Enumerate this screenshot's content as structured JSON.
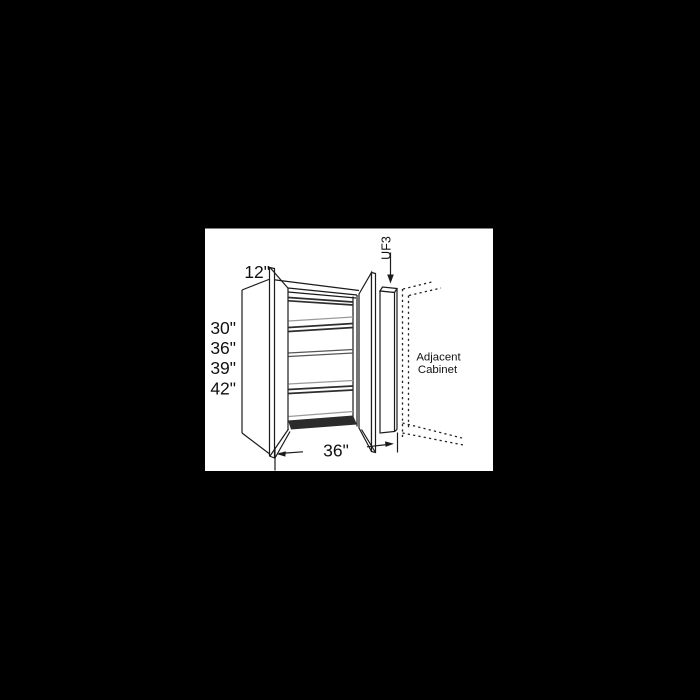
{
  "background": {
    "page_color": "#000000",
    "panel_color": "#ffffff"
  },
  "diagram": {
    "type": "wall-cabinet-line-drawing",
    "depth_label": "12\"",
    "height_labels": [
      "30\"",
      "36\"",
      "39\"",
      "42\""
    ],
    "width_label": "36\"",
    "filler_label": "UF3",
    "adjacent_line1": "Adjacent",
    "adjacent_line2": "Cabinet",
    "colors": {
      "line": "#1b1b1b",
      "shelf_gray": "#9a9a9a",
      "text": "#111111",
      "page": "#000000",
      "panel": "#ffffff"
    }
  }
}
